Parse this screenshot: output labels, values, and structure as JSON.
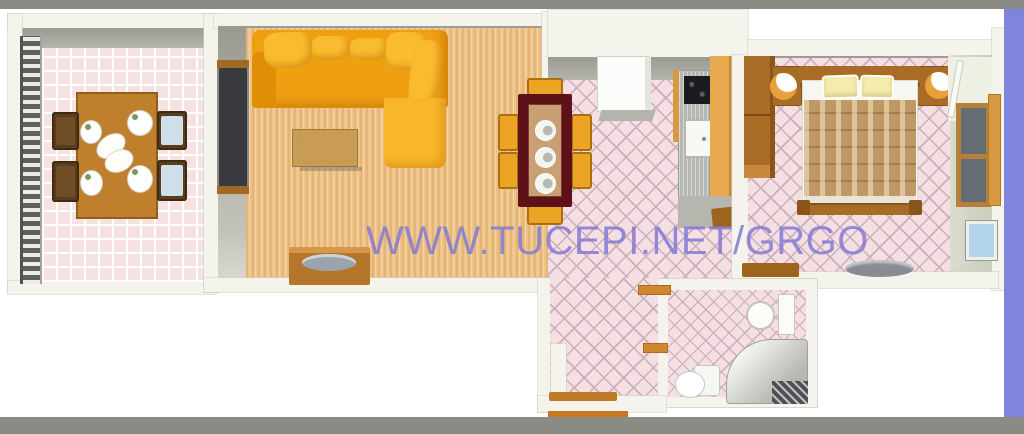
{
  "watermark": {
    "text": "WWW.TUCEPI.NET/GRGO",
    "color": "#837bd4"
  },
  "palette": {
    "frame_gray": "#8b8b85",
    "frame_periwinkle": "#7f84dc",
    "wall": "#f4f4ec",
    "wall_shadow": "#a2a29a",
    "wood_floor": "#eec287",
    "tile_pink": "#f5dfe3",
    "tile_line": "#c9aebb",
    "terrace_tile": "#f6e3e1",
    "sofa_orange": "#ef9f10",
    "sofa_cushion": "#f9bb2f",
    "chaise": "#f8b72b",
    "table_dark_red": "#5e1118",
    "table_inner": "#c99f76",
    "chair_yellow": "#eca424",
    "chair_yellow_edge": "#a87012",
    "wood_furniture": "#a86c26",
    "wood_dark": "#8a5518",
    "wood_light": "#c8893c",
    "shelf_brown": "#9c641d",
    "door_orange": "#c87820",
    "shelf_orange": "#d08830",
    "counter_gray": "#b5b7b3",
    "stove_black": "#1a1b1f",
    "cabinet_orange": "#e9aa4f",
    "blanket_brown": "#bf9866",
    "pillow_yellow": "#f3ecae",
    "window_blue": "#b3d5e9",
    "watermark_color": "#837bd4"
  },
  "rooms": {
    "terrace": {
      "furniture": [
        "railing",
        "dining-table",
        "four-chairs",
        "four-plates",
        "serving-dish"
      ]
    },
    "living_room": {
      "furniture": [
        "corner-sofa",
        "coffee-table",
        "tv-cabinet",
        "balcony-door"
      ]
    },
    "kitchen": {
      "furniture": [
        "dining-table-dark-red",
        "six-chairs",
        "three-plates",
        "fridge",
        "counter",
        "stove",
        "sink",
        "tall-cabinet",
        "desk"
      ]
    },
    "bedroom": {
      "furniture": [
        "double-bed",
        "two-pillows",
        "plaid-blanket",
        "wardrobe",
        "two-bedside-lamps",
        "window",
        "blue-window",
        "door",
        "shelf",
        "tray"
      ]
    },
    "bathroom": {
      "furniture": [
        "sink",
        "mirror",
        "toilet",
        "corner-shower",
        "drain-grate"
      ]
    },
    "hallway": {
      "furniture": [
        "entrance-threshold",
        "stub-wall",
        "two-shelves"
      ]
    }
  }
}
